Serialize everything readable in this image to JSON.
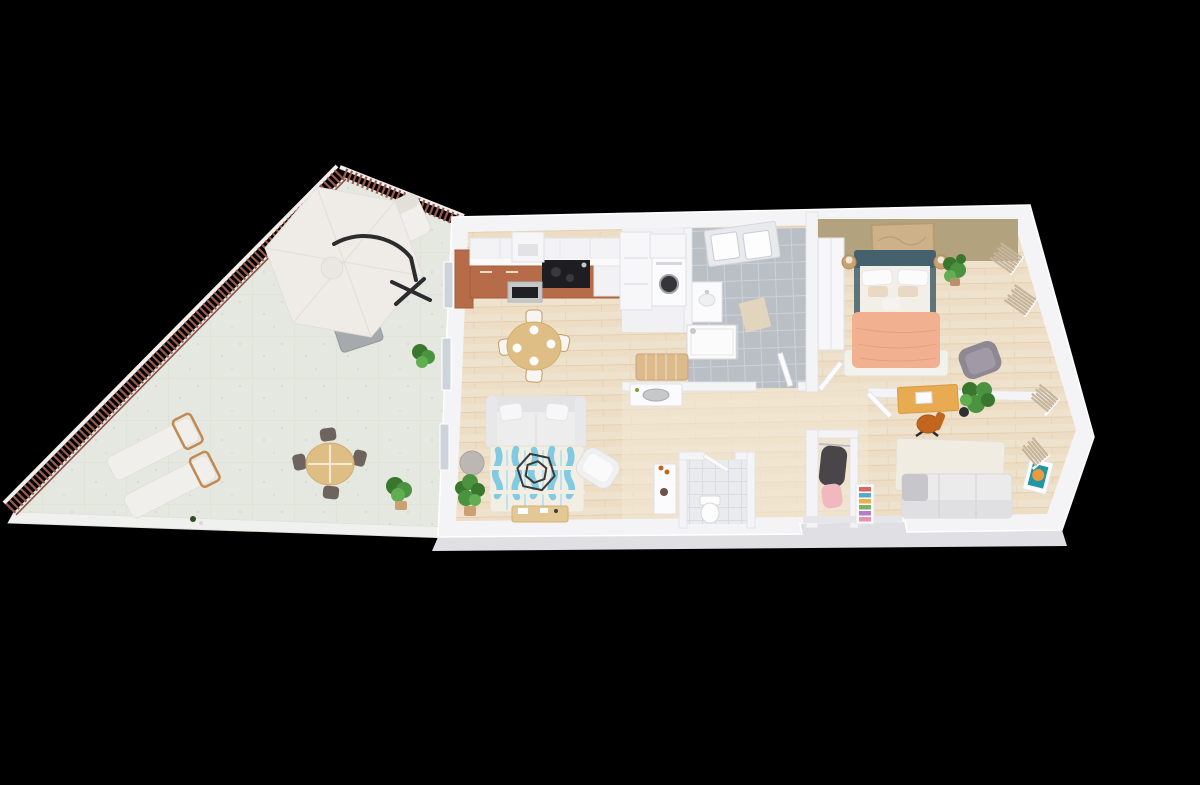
{
  "meta": {
    "title": "3D isometric floor-plan render: one-bedroom apartment with triangular corner terrace",
    "style": "photoreal 3D dollhouse view on black background"
  },
  "palette": {
    "bg": "#000000",
    "wall": "#f4f4f6",
    "wallEdge": "#e1e1e6",
    "wallFace": "#e0e0e4",
    "terraceFloor": "#e5e8e1",
    "terraceWalk": "#f0f1ee",
    "railBrown": "#9b5a4e",
    "railWhite": "#f1efec",
    "wood": "#ecddc4",
    "woodLine": "#d9c3a2",
    "hallWood": "#f3e8d5",
    "bathTile": "#babfc6",
    "bathGrout": "#ccd1d7",
    "wcTile": "#e9ebee",
    "wcGrout": "#d9dce1",
    "cabTerracotta": "#b76c49",
    "counter": "#fafafa",
    "cooktop": "#1e1e22",
    "steel": "#c6c8ca",
    "tableWood": "#dfbe85",
    "chairFrame": "#c49a62",
    "sofa": "#ededee",
    "sofaShade": "#e3e3e6",
    "rugBase": "#f3eee3",
    "rugBlue": "#6cc3e0",
    "rugBlueLight": "#b5e0ef",
    "wire": "#3c3a38",
    "pouf": "#bcb7b2",
    "plant": "#4c9341",
    "plantDark": "#39772f",
    "potTan": "#c9a173",
    "headboard": "#44616d",
    "sheet": "#f2efe9",
    "blanket": "#f1b190",
    "blanketFold": "#e09a78",
    "bedRug": "#f3f1ec",
    "accent": "#b2a27d",
    "artTan": "#ccb189",
    "grayChair": "#8e8893",
    "curtain": "#c6b59d",
    "deskWood": "#e8ab51",
    "chairOrange": "#c2661f",
    "daybed": "#ebebec",
    "artTeal": "#2496a3",
    "artOrange": "#e79b3d",
    "umbrella": "#efece8",
    "umbrellaSeam": "#e3e0da",
    "arm": "#2c2c2e",
    "outBench": "#a7aaac",
    "loungerWood": "#c28a52",
    "outChair": "#6c645d",
    "wine": "#2f4d20",
    "coat": "#4a4548",
    "pink": "#f2b8c0",
    "glass": "#ccd4da",
    "washerDark": "#34343a",
    "benchWood": "#dcba8c"
  },
  "books": [
    "#d96a5a",
    "#5aa9c9",
    "#e9b34c",
    "#7fb069",
    "#b07fc9",
    "#e98fb0"
  ],
  "rooms": {
    "terrace": {
      "name": "terrace",
      "features": [
        "corner-railing",
        "cantilever-parasol",
        "outdoor-sofa",
        "garden-bench",
        "sun-lounger",
        "sun-lounger",
        "wine-bottle",
        "round-bistro-table",
        "four-bistro-chairs",
        "shrub",
        "shrub"
      ]
    },
    "living_kitchen": {
      "name": "open living / kitchen",
      "features": [
        "terracotta-kitchen-run",
        "range-hood",
        "cooktop",
        "oven",
        "tall-unit",
        "round-dining-table",
        "four-dining-chairs",
        "white-sofa",
        "ikat-rug",
        "wire-coffee-table",
        "gray-pouf",
        "white-armchair",
        "fiddle-leaf-plant",
        "media-sideboard"
      ]
    },
    "laundry": {
      "name": "laundry nook",
      "features": [
        "washing-machine",
        "storage-cabinet"
      ]
    },
    "bathroom": {
      "name": "bathroom",
      "features": [
        "skylight",
        "vanity-sink",
        "walk-in-shower",
        "bath-mat",
        "door"
      ]
    },
    "wc": {
      "name": "wc",
      "features": [
        "toilet",
        "flower-console"
      ]
    },
    "hallway": {
      "name": "hallway",
      "features": [
        "slat-bench",
        "bowl-console",
        "entry-closet-coat",
        "pink-garment",
        "entrance-recess"
      ]
    },
    "bedroom": {
      "name": "bedroom",
      "features": [
        "olive-accent-wall",
        "framed-art",
        "wardrobe",
        "double-bed-teal-headboard",
        "peach-blanket",
        "nightstand",
        "nightstand",
        "plant",
        "gray-armchair",
        "curtained-windows"
      ]
    },
    "office": {
      "name": "office / second bedroom",
      "features": [
        "wood-desk",
        "orange-desk-chair",
        "palm-plant",
        "white-rug",
        "daybed",
        "bookshelf",
        "teal-wall-art",
        "curtained-windows"
      ]
    }
  }
}
